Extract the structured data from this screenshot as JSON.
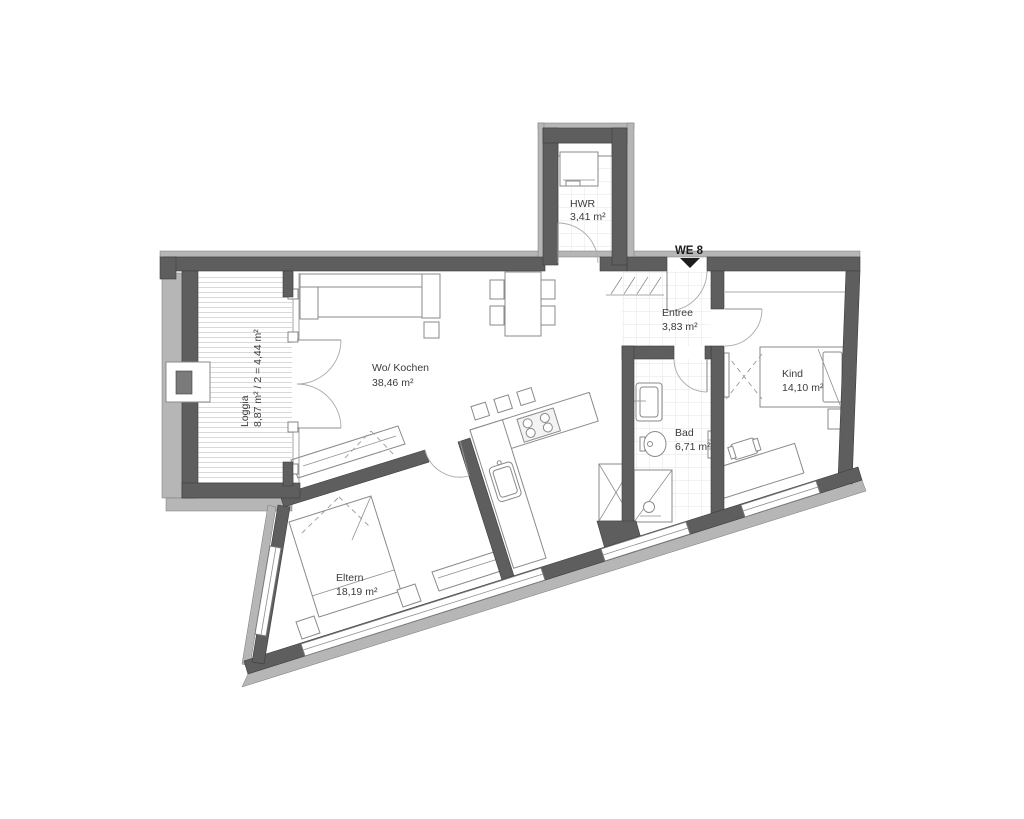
{
  "unit": {
    "label": "WE 8"
  },
  "rooms": [
    {
      "id": "hwr",
      "name": "HWR",
      "area": "3,41 m²"
    },
    {
      "id": "entree",
      "name": "Entree",
      "area": "3,83 m²"
    },
    {
      "id": "wohnen",
      "name": "Wo/ Kochen",
      "area": "38,46 m²"
    },
    {
      "id": "kind",
      "name": "Kind",
      "area": "14,10 m²"
    },
    {
      "id": "bad",
      "name": "Bad",
      "area": "6,71 m²"
    },
    {
      "id": "eltern",
      "name": "Eltern",
      "area": "18,19 m²"
    },
    {
      "id": "loggia",
      "name": "Loggia",
      "area": "8,87 m² / 2 = 4,44 m²"
    }
  ],
  "colors": {
    "wall": "#5e5e5e",
    "wall_light": "#b6b6b6",
    "furniture_line": "#8a8a8a",
    "text": "#3b3b3b",
    "background": "#ffffff"
  }
}
